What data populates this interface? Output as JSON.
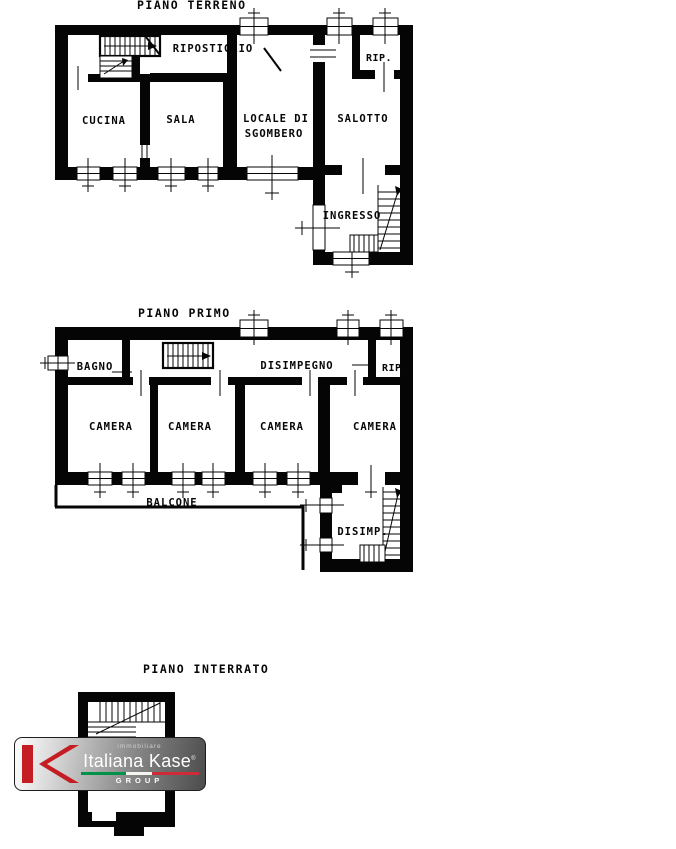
{
  "floors": {
    "ground": {
      "title": "PIANO TERRENO",
      "rooms": {
        "cucina": "CUCINA",
        "sala": "SALA",
        "ripostiglio": "RIPOSTIGLIO",
        "locale_di": "LOCALE DI",
        "sgombero": "SGOMBERO",
        "rip": "RIP.",
        "salotto": "SALOTTO",
        "ingresso": "INGRESSO"
      }
    },
    "first": {
      "title": "PIANO PRIMO",
      "rooms": {
        "bagno": "BAGNO",
        "disimpegno": "DISIMPEGNO",
        "rip": "RIP.",
        "camera1": "CAMERA",
        "camera2": "CAMERA",
        "camera3": "CAMERA",
        "camera4": "CAMERA",
        "balcone": "BALCONE",
        "disimp": "DISIMP."
      }
    },
    "basement": {
      "title": "PIANO INTERRATO"
    }
  },
  "logo": {
    "tagline": "immobiliare",
    "brand": "Italiana Kase",
    "mark": "®",
    "group": "GROUP",
    "monogram": "IK",
    "colors": {
      "red": "#C41E24",
      "flag_green": "#009246",
      "flag_white": "#F4F5F0",
      "flag_red": "#CE2B37"
    }
  }
}
